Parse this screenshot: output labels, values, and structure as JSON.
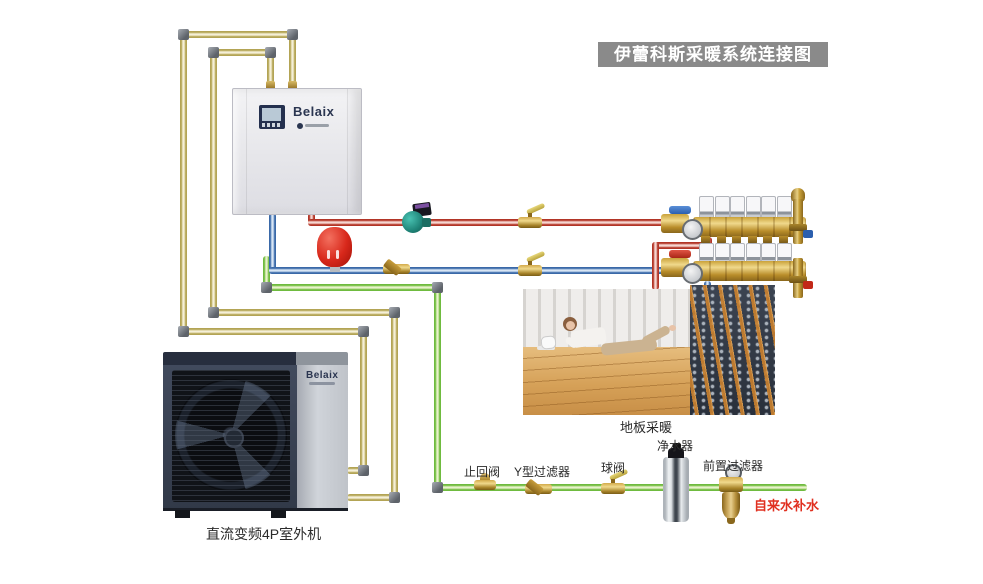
{
  "banner": {
    "title": "伊蕾科斯采暖系统连接图"
  },
  "indoor_unit": {
    "brand": "Belaix"
  },
  "outdoor_unit": {
    "brand": "Belaix",
    "label": "直流变频4P室外机"
  },
  "floor_heating": {
    "label": "地板采暖"
  },
  "fittings": {
    "check_valve": "止回阀",
    "y_strainer": "Y型过滤器",
    "ball_valve": "球阀",
    "water_purifier": "净水器",
    "pre_filter": "前置过滤器",
    "tap_water_makeup": "自来水补水"
  },
  "colors": {
    "banner_bg": "#8a8a8a",
    "hot_supply_pipe": "#c0392b",
    "return_pipe": "#3a69a8",
    "fill_water_pipe": "#6fbb3f",
    "refrigerant_pipe": "#b3a455",
    "tap_water_text": "#e03020"
  }
}
